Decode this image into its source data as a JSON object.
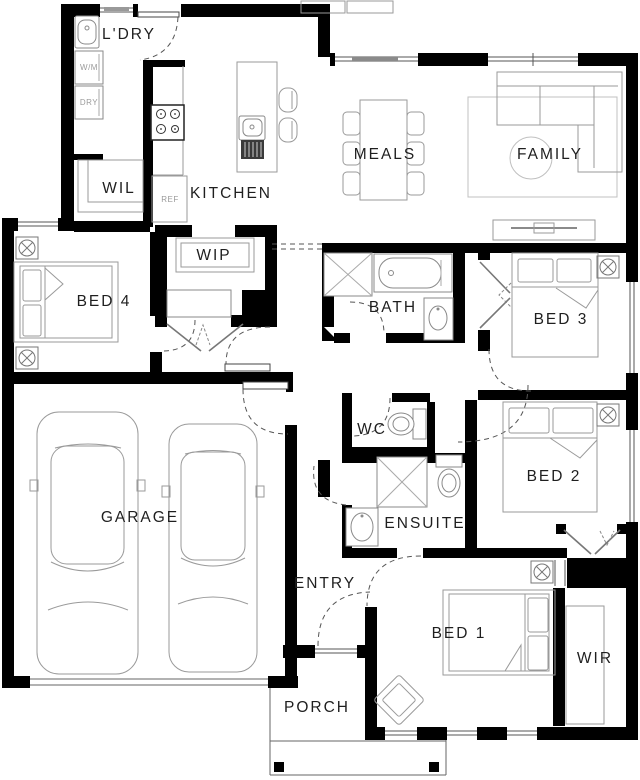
{
  "plan": {
    "type": "house-floor-plan",
    "rooms": {
      "ldry": {
        "label": "L'DRY"
      },
      "wil": {
        "label": "WIL"
      },
      "kitchen": {
        "label": "KITCHEN"
      },
      "wip": {
        "label": "WIP"
      },
      "meals": {
        "label": "MEALS"
      },
      "family": {
        "label": "FAMILY"
      },
      "bed4": {
        "label": "BED 4"
      },
      "bath": {
        "label": "BATH"
      },
      "bed3": {
        "label": "BED 3"
      },
      "garage": {
        "label": "GARAGE"
      },
      "wc": {
        "label": "WC"
      },
      "bed2": {
        "label": "BED 2"
      },
      "ensuite": {
        "label": "ENSUITE"
      },
      "entry": {
        "label": "ENTRY"
      },
      "bed1": {
        "label": "BED 1"
      },
      "wir": {
        "label": "WIR"
      },
      "porch": {
        "label": "PORCH"
      }
    },
    "appliances": {
      "wm": "W/M",
      "dry": "DRY",
      "ref": "REF"
    },
    "colors": {
      "wall": "#000000",
      "furniture_stroke": "#9a9a9a",
      "fixture_stroke": "#8a8a8a",
      "label_text": "#1f1f1f",
      "appliance_text": "#9a9a9a",
      "background": "#ffffff"
    }
  }
}
